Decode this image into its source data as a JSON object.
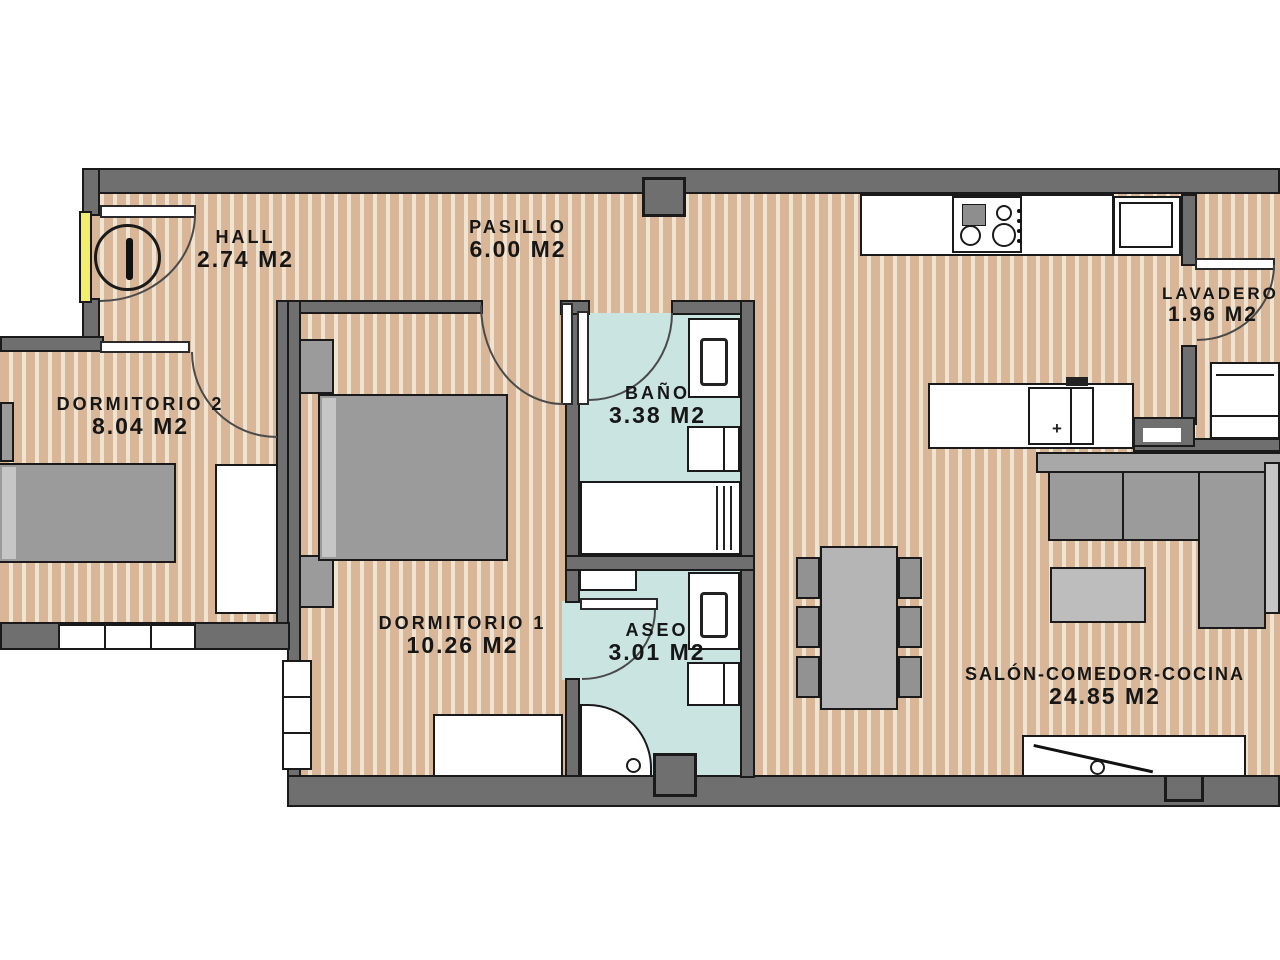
{
  "title": "Apartment floor plan",
  "rooms": {
    "hall": {
      "name": "HALL",
      "area": "2.74 M2"
    },
    "pasillo": {
      "name": "PASILLO",
      "area": "6.00 M2"
    },
    "dormitorio2": {
      "name": "DORMITORIO 2",
      "area": "8.04 M2"
    },
    "bano": {
      "name": "BAÑO",
      "area": "3.38 M2"
    },
    "dormitorio1": {
      "name": "DORMITORIO 1",
      "area": "10.26 M2"
    },
    "aseo": {
      "name": "ASEO",
      "area": "3.01 M2"
    },
    "salon": {
      "name": "SALÓN-COMEDOR-COCINA",
      "area": "24.85 M2"
    },
    "lavadero": {
      "name": "LAVADERO",
      "area": "1.96 M2"
    }
  },
  "symbols": {
    "sink_tap": "+"
  },
  "colors": {
    "wood_floor": "#d8b697",
    "wood_stripe": "#efe4d2",
    "wall": "#6f6f6f",
    "wet_room_tile": "#c9e4e1",
    "furniture_gray": "#9b9b9b",
    "entrance_door": "#f0ee6a",
    "outline": "#1a1a1a"
  }
}
